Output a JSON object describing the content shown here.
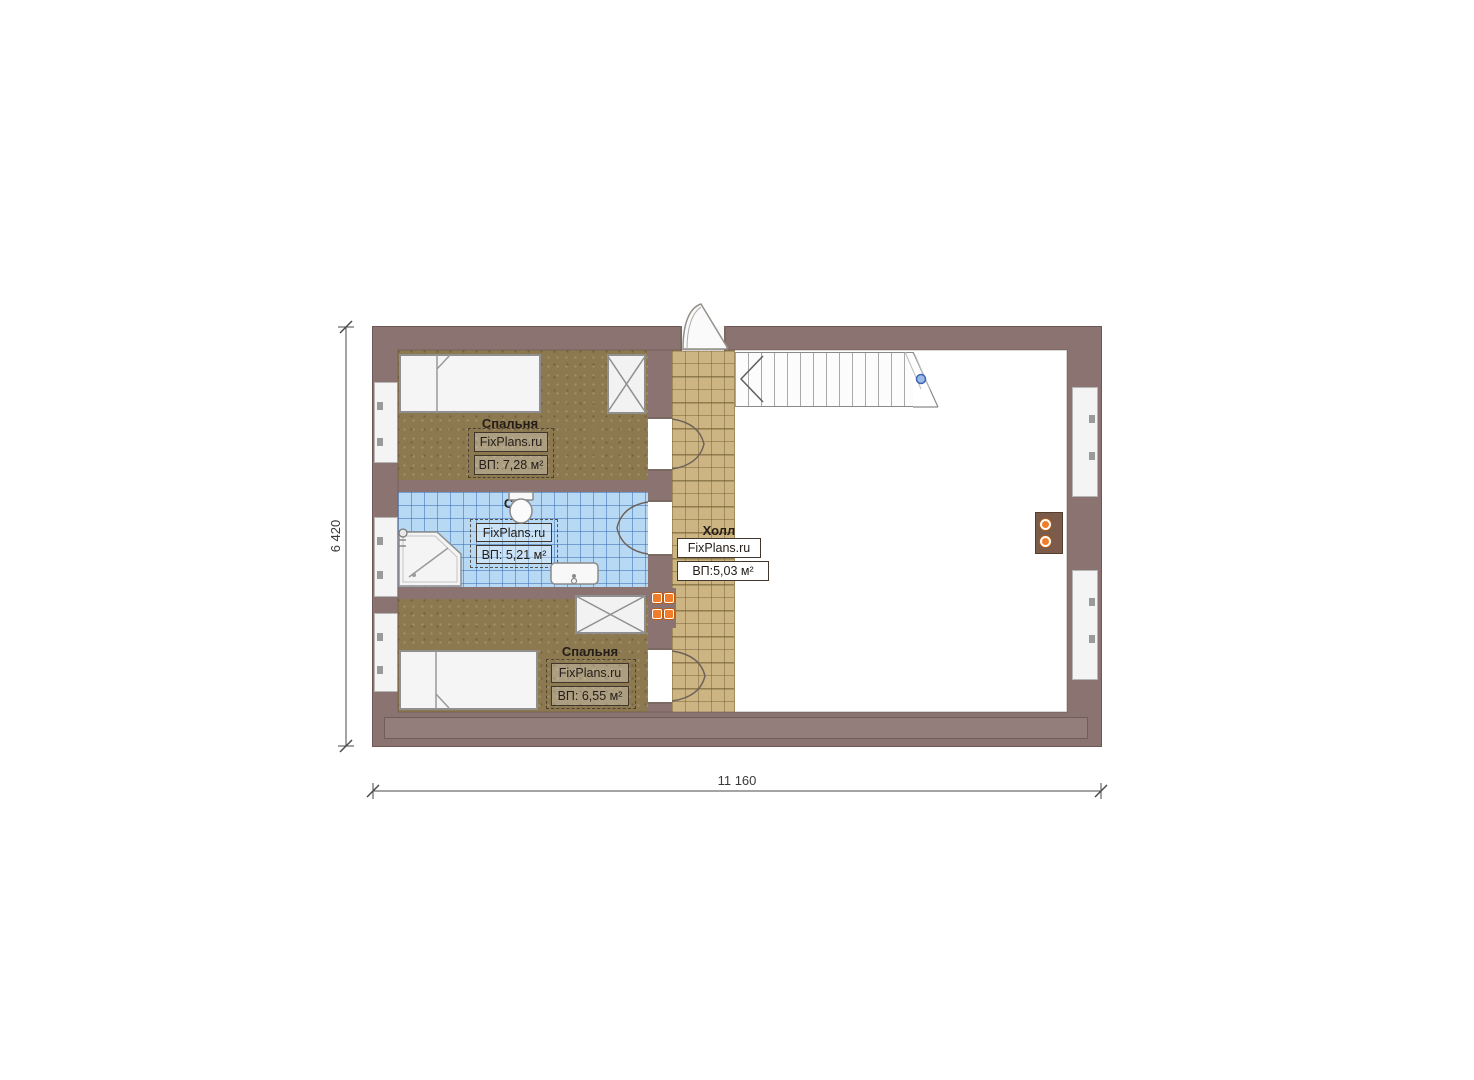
{
  "plan": {
    "brand_label": "FixPlans.ru",
    "rooms": {
      "bedroom_top": {
        "name": "Спальня",
        "area": "ВП: 7,28 м²"
      },
      "bathroom": {
        "name": "С/у",
        "area": "ВП: 5,21 м²"
      },
      "hall": {
        "name": "Холл",
        "area": "ВП:5,03 м²"
      },
      "bedroom_bottom": {
        "name": "Спальня",
        "area": "ВП: 6,55 м²"
      }
    },
    "dimensions": {
      "horizontal": "11 160",
      "vertical": "6 420"
    },
    "colors": {
      "wall": "#8b7372",
      "bedroom_floor": "#8c7950",
      "hall_tile": "#cdb583",
      "bath_tile": "#b7d9f3",
      "accent_orange": "#f07d2a",
      "stair_marker_blue": "#3c66b5"
    }
  }
}
